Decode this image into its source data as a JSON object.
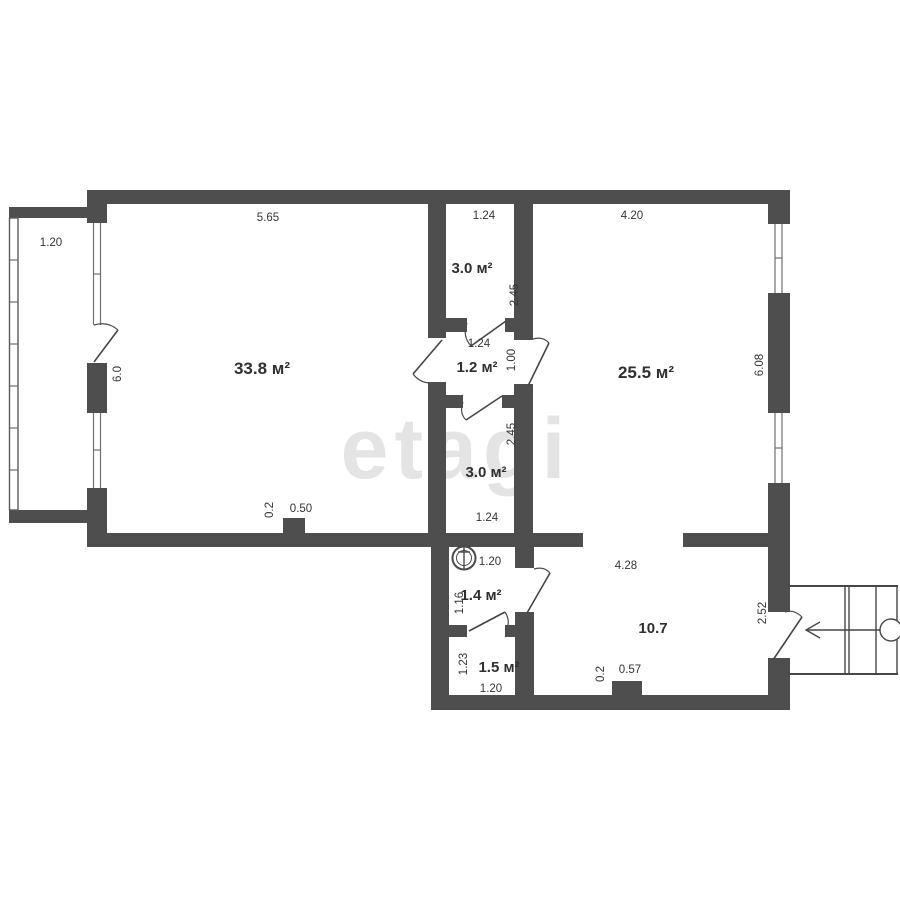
{
  "watermark": "etagi",
  "rooms": {
    "living": "33.8 м²",
    "bedroom": "25.5 м²",
    "storage_top": "3.0 м²",
    "hallway": "1.2 м²",
    "storage_mid": "3.0 м²",
    "bathroom": "1.4 м²",
    "toilet": "1.5 м²",
    "corridor": "10.7"
  },
  "dimensions": {
    "balcony_width": "1.20",
    "living_width": "5.65",
    "living_height": "6.0",
    "living_ledge_depth": "0.2",
    "living_ledge_width": "0.50",
    "storage_top_width": "1.24",
    "storage_top_height": "2.45",
    "bedroom_width": "4.20",
    "bedroom_height": "6.08",
    "hallway_width": "1.24",
    "hallway_door_width": "1.00",
    "storage_mid_height": "2.45",
    "storage_mid_width": "1.24",
    "bathroom_width": "1.20",
    "bathroom_height": "1.16",
    "corridor_width": "4.28",
    "corridor_ledge_depth": "0.2",
    "corridor_ledge_width": "0.57",
    "entry_wall_height": "2.52",
    "toilet_height": "1.23",
    "toilet_width": "1.20"
  },
  "colors": {
    "wall": "#4e4e4e",
    "line": "#454545",
    "text": "#343434",
    "watermark": "#e4e4e4",
    "background": "#ffffff"
  }
}
